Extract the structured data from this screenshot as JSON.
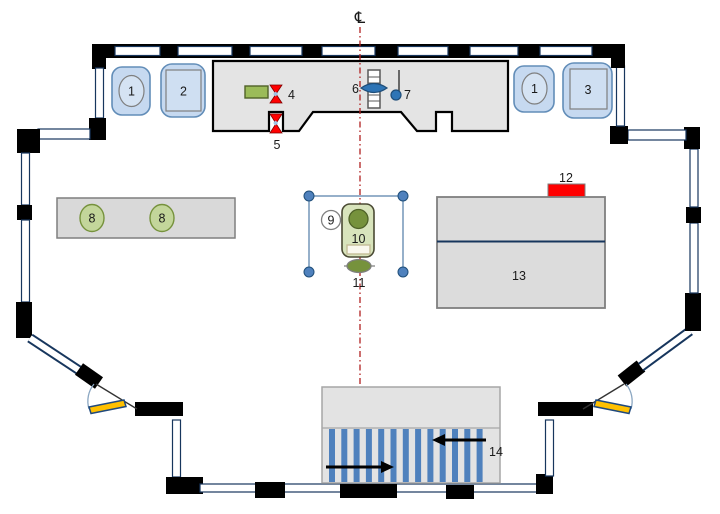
{
  "diagram": {
    "type": "floor-plan",
    "centerline_symbol": "℄",
    "callouts": {
      "booth_left_1": "1",
      "booth_left_2": "2",
      "booth_right_1": "1",
      "booth_right_3": "3",
      "stage_item_4": "4",
      "stage_item_5": "5",
      "stage_item_6": "6",
      "stage_item_7": "7",
      "table_oval_8a": "8",
      "table_oval_8b": "8",
      "center_item_9": "9",
      "center_item_10": "10",
      "center_item_11": "11",
      "cabinet_item_12": "12",
      "cabinet_item_13": "13",
      "entry_item_14": "14"
    },
    "palette": {
      "wall_black": "#000000",
      "window_navy": "#17365d",
      "stage_gray": "#e4e4e4",
      "panel_gray": "#d9d9d9",
      "booth_blue": "#c6d9f0",
      "accent_blue": "#4f81bd",
      "lens_blue": "#2e75b6",
      "olive_dark": "#76923c",
      "olive_light": "#c3d69b",
      "green_box": "#d8e4bc",
      "item4_green": "#9bbb59",
      "red": "#ff0000",
      "centerline_red": "#b02020",
      "door_yellow": "#ffc000",
      "stripe_blue": "#4f81bd"
    }
  }
}
